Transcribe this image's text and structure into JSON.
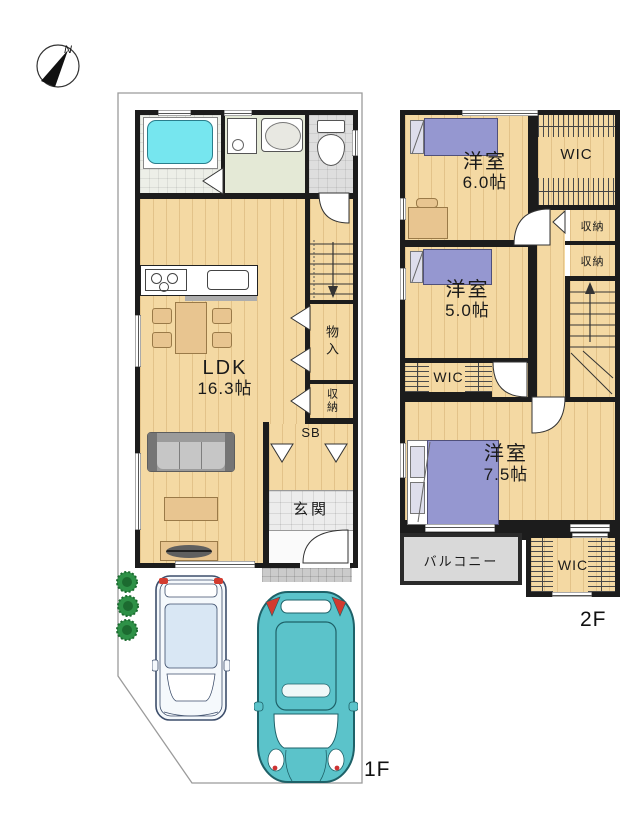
{
  "compass": {
    "north": "N"
  },
  "floor1": {
    "label": "1F",
    "ldk_name": "LDK",
    "ldk_size": "16.3帖",
    "monoire": "物入",
    "shunou": "収納",
    "sb": "SB",
    "genkan": "玄関"
  },
  "floor2": {
    "label": "2F",
    "room60_name": "洋室",
    "room60_size": "6.0帖",
    "room50_name": "洋室",
    "room50_size": "5.0帖",
    "room75_name": "洋室",
    "room75_size": "7.5帖",
    "wic_top": "WIC",
    "closet_a": "収納",
    "closet_b": "収納",
    "wic_mid": "WIC",
    "wic_bottom": "WIC",
    "balcony": "バルコニー"
  },
  "colors": {
    "wall": "#1c1c1c",
    "wood": "#F4D9A3",
    "woodline": "rgba(165,115,45,0.22)",
    "tub": "#76E6EF",
    "bathFloor": "#EDEFE8",
    "washFloor": "#E4E9D6",
    "wcFloor": "#DEDEDE",
    "tile": "#ECECEC",
    "porch": "#CBCBCB",
    "balcony": "#D9D9D9",
    "bed": "#9597D0",
    "pillow": "#DEDEEC",
    "furn": "#E8C590",
    "furnEdge": "#9A7A48",
    "sofa": "#9B9B9B",
    "sofaSeat": "#C6C6C6",
    "tv": "#5F5F5F",
    "carTeal": "#5BC3CA",
    "carTealEdge": "#1E6168",
    "carPale": "#F5F9FC",
    "carPaleEdge": "#3D4E6B",
    "carRoof": "#D9E7F4",
    "plant": "#2E9147",
    "plantEdge": "#1C6B30",
    "boundary": "#9B9B9B"
  }
}
